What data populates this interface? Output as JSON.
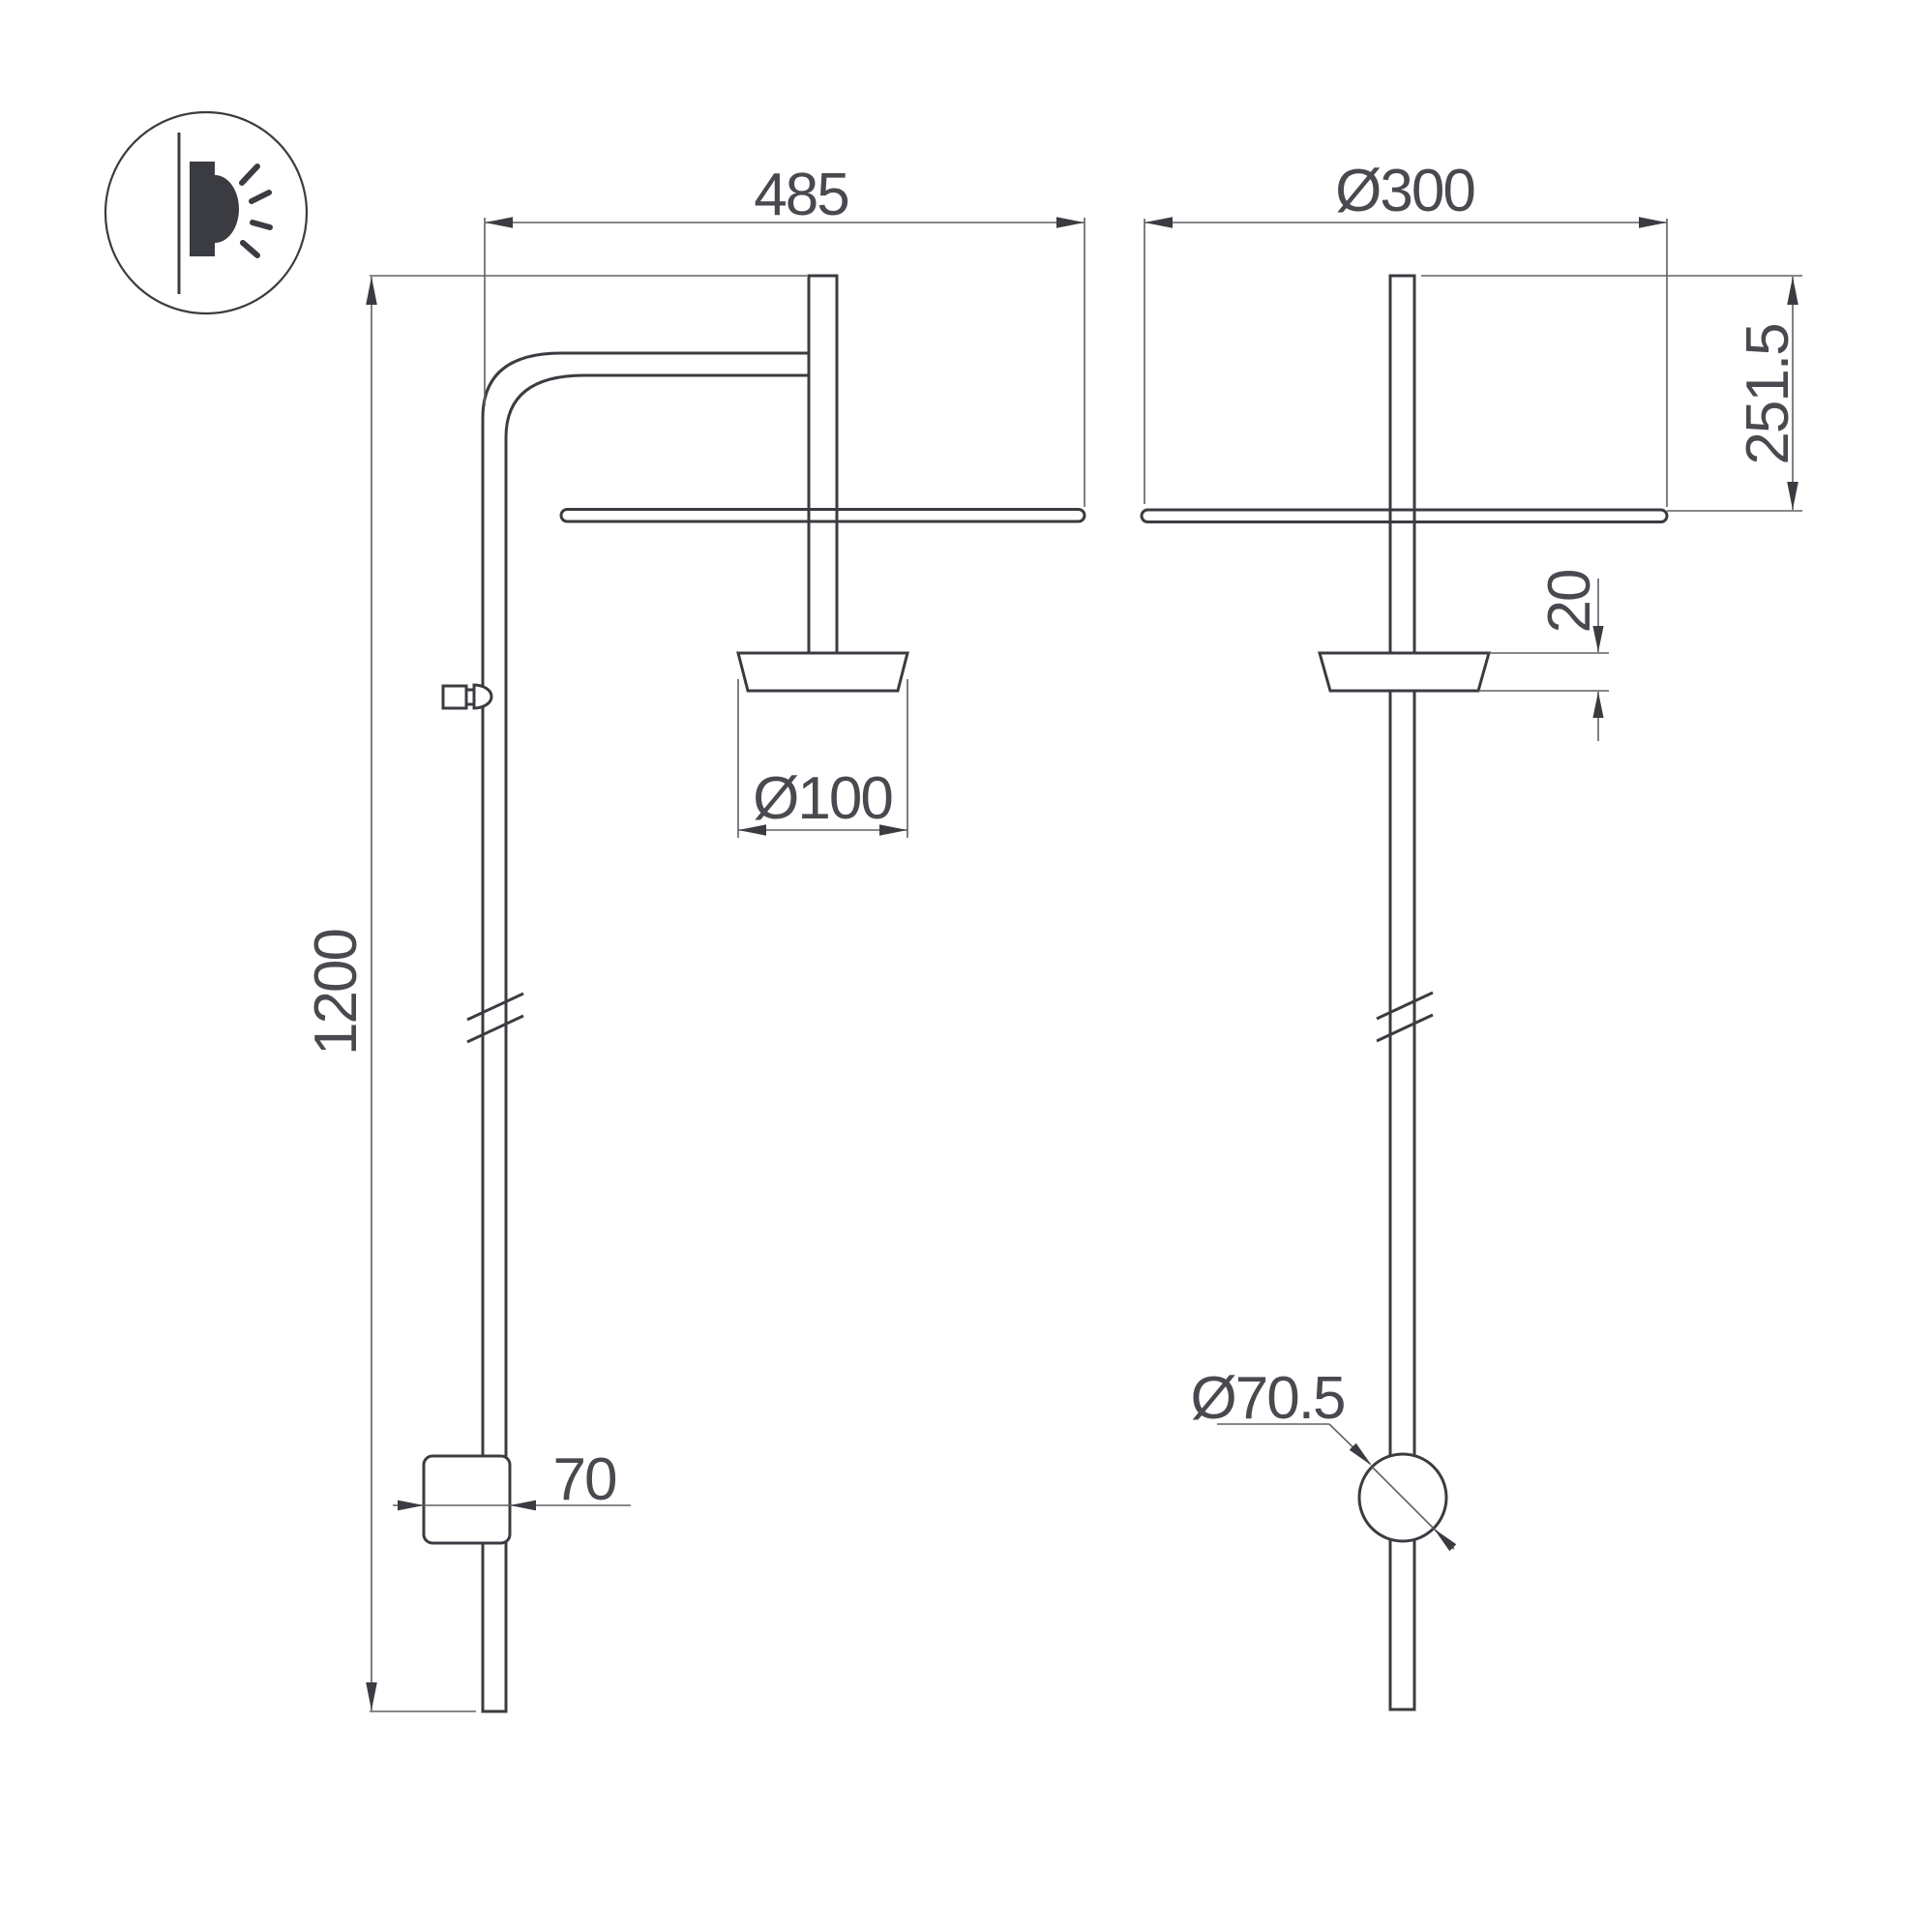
{
  "drawing": {
    "type": "technical-dimension-drawing",
    "icon": {
      "label": "wall-mounted-light-icon"
    },
    "dimensions": {
      "d485": "485",
      "d1200": "1200",
      "d70": "70",
      "d100": "Ø100",
      "d300": "Ø300",
      "d2515": "251.5",
      "d20": "20",
      "d705": "Ø70.5"
    },
    "colors": {
      "object_line": "#3b3c41",
      "dimension_line": "#5f6065",
      "text": "#494a4f",
      "background": "#ffffff"
    }
  }
}
